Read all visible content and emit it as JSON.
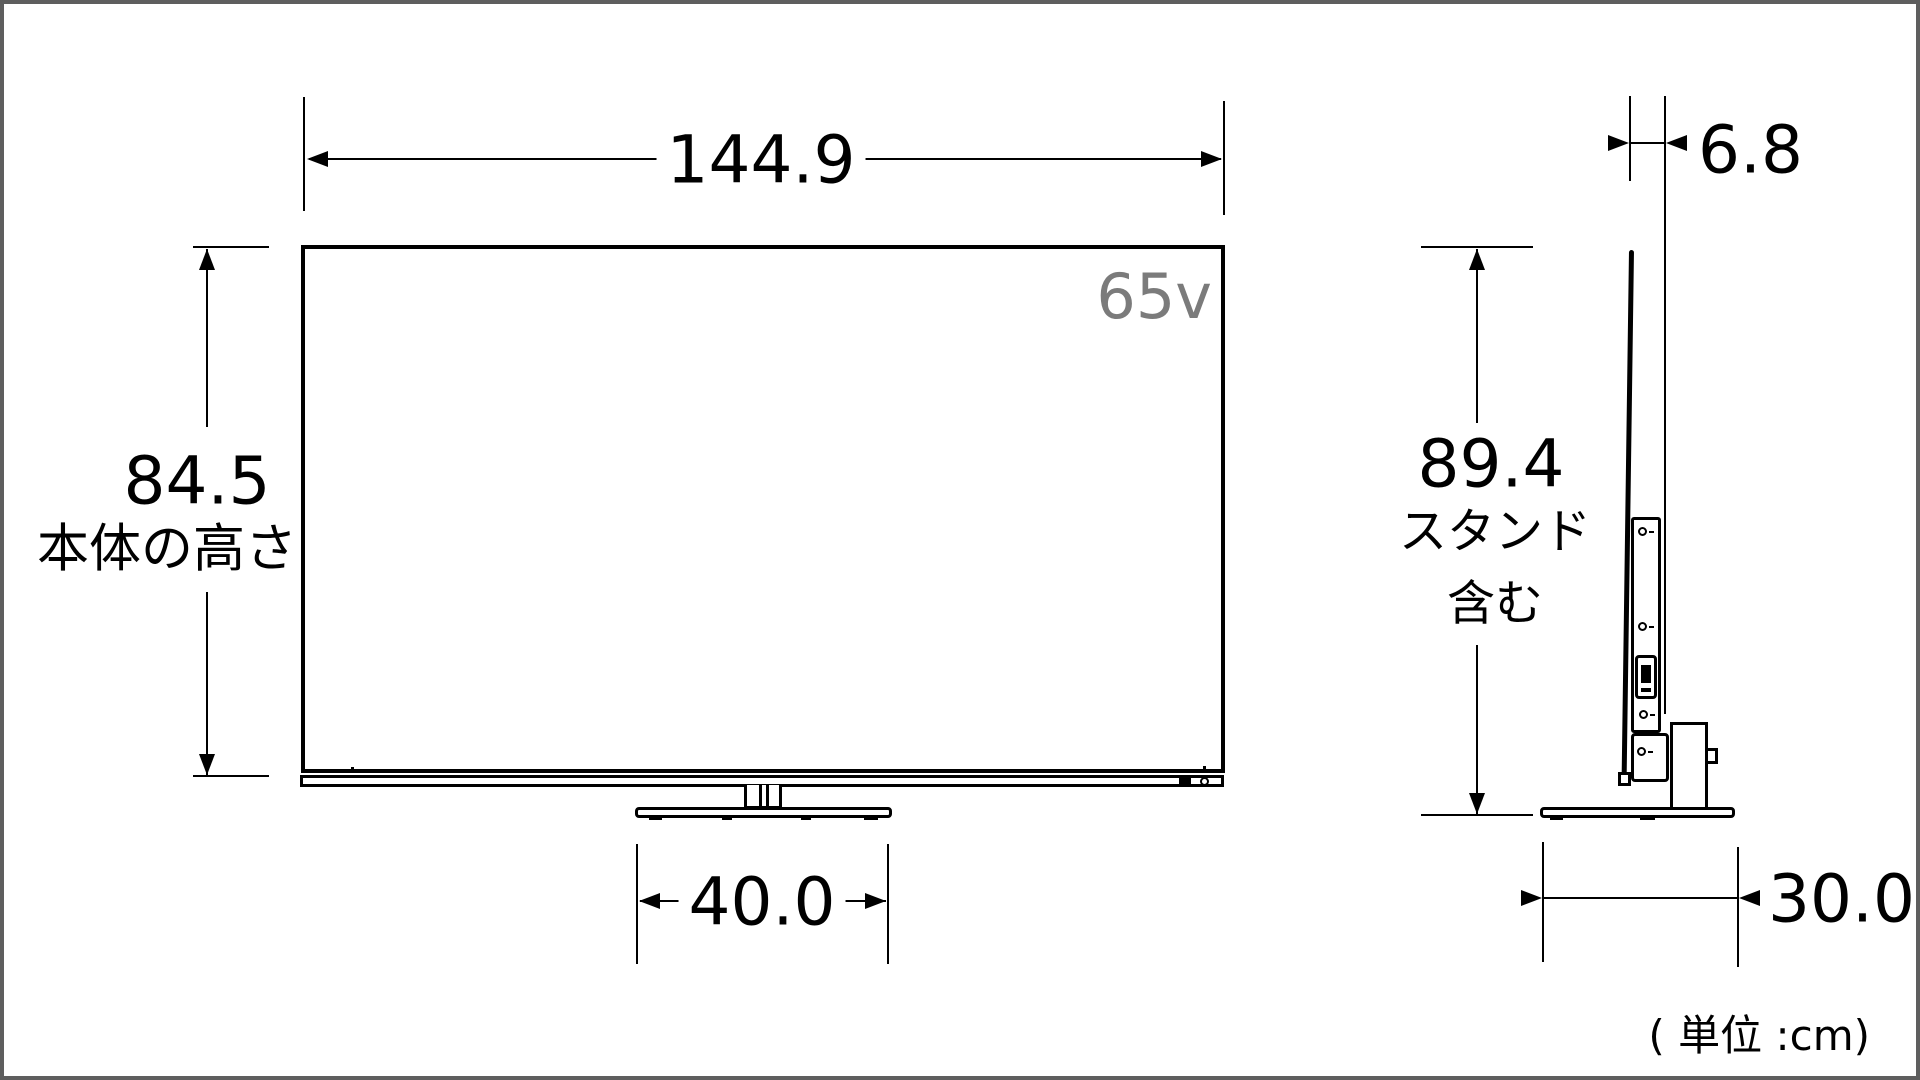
{
  "front_view": {
    "screen_label": "65v",
    "width": {
      "value": "144.9"
    },
    "body_height": {
      "value": "84.5",
      "caption": "本体の高さ"
    },
    "stand_width": {
      "value": "40.0"
    }
  },
  "side_view": {
    "depth": {
      "value": "6.8"
    },
    "total_height": {
      "value": "89.4",
      "caption_line1": "スタンド",
      "caption_line2": "含む"
    },
    "base_depth": {
      "value": "30.0"
    }
  },
  "footer": {
    "unit_note": "( 単位 :cm)"
  },
  "colors": {
    "line": "#000000",
    "screen_label_gray": "#7b7b7b",
    "frame_border": "#5e5e5e"
  }
}
